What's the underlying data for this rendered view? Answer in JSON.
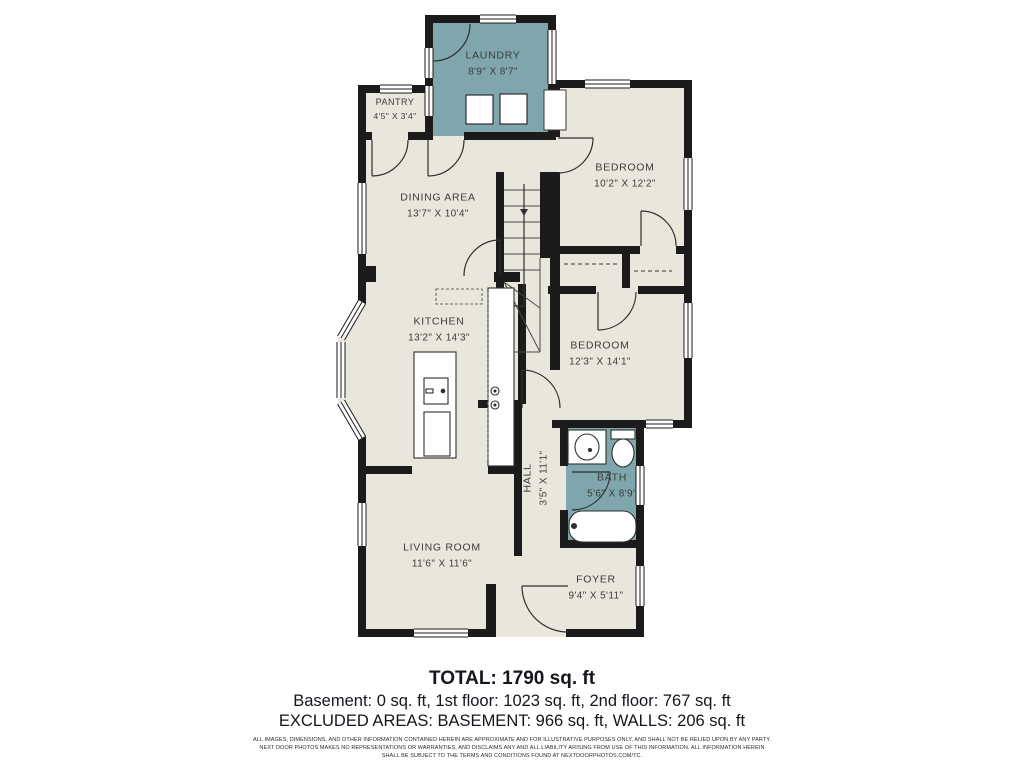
{
  "colors": {
    "background": "#ffffff",
    "floor": "#e9e7dc",
    "accent_teal": "#7ea6ac",
    "walls": "#1b1b1b",
    "label_text": "#3c3c3c",
    "summary_text": "#15151d"
  },
  "rooms": [
    {
      "id": "laundry",
      "name": "LAUNDRY",
      "dims": "8'9\" X 8'7\""
    },
    {
      "id": "pantry",
      "name": "PANTRY",
      "dims": "4'5\" X 3'4\""
    },
    {
      "id": "dining-area",
      "name": "DINING AREA",
      "dims": "13'7\" X 10'4\""
    },
    {
      "id": "bedroom-1",
      "name": "BEDROOM",
      "dims": "10'2\" X 12'2\""
    },
    {
      "id": "kitchen",
      "name": "KITCHEN",
      "dims": "13'2\" X 14'3\""
    },
    {
      "id": "bedroom-2",
      "name": "BEDROOM",
      "dims": "12'3\" X 14'1\""
    },
    {
      "id": "hall",
      "name": "HALL",
      "dims": "3'5\" X 11'1\""
    },
    {
      "id": "bath",
      "name": "BATH",
      "dims": "5'6\" X 8'9\""
    },
    {
      "id": "living-room",
      "name": "LIVING ROOM",
      "dims": "11'6\" X 11'6\""
    },
    {
      "id": "foyer",
      "name": "FOYER",
      "dims": "9'4\" X 5'11\""
    }
  ],
  "summary": {
    "total": "TOTAL: 1790 sq. ft",
    "floors": "Basement: 0 sq. ft, 1st floor: 1023 sq. ft, 2nd floor: 767 sq. ft",
    "excluded": "EXCLUDED AREAS: BASEMENT: 966 sq. ft, WALLS: 206 sq. ft"
  },
  "disclaimer": {
    "lines": [
      "ALL IMAGES, DIMENSIONS, AND OTHER INFORMATION CONTAINED HEREIN ARE APPROXIMATE AND FOR ILLUSTRATIVE PURPOSES ONLY, AND SHALL NOT BE RELIED UPON BY ANY PARTY.",
      "NEXT DOOR PHOTOS MAKES NO REPRESENTATIONS OR WARRANTIES, AND DISCLAIMS ANY AND ALL LIABILITY ARISING FROM USE OF THIS INFORMATION. ALL INFORMATION HEREIN",
      "SHALL BE SUBJECT TO THE TERMS AND CONDITIONS FOUND AT NEXTDOORPHOTOS.COM/TC."
    ]
  }
}
